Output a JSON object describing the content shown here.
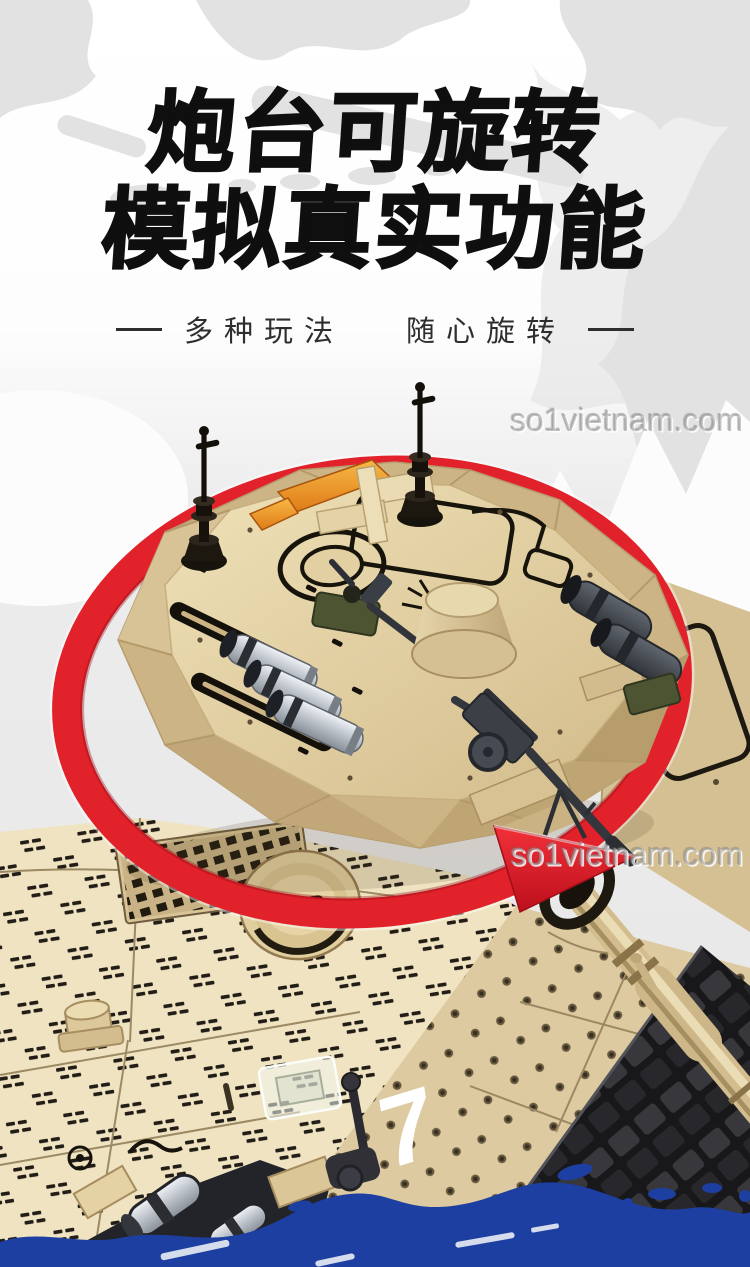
{
  "banner": {
    "headline": {
      "line1": "炮台可旋转",
      "line2": "模拟真实功能"
    },
    "subtitle": {
      "left": "多种玩法",
      "right": "随心旋转"
    },
    "watermark": "so1vietnam.com",
    "hull_marking": "7"
  },
  "colors": {
    "accent_red": "#e2222a",
    "wave_blue": "#1d3fa2",
    "title_black": "#0f0f0f",
    "tan_light": "#f0e4c3",
    "tan_mid": "#dfcb9e",
    "tan_dark": "#c9b080",
    "map_gray": "#e2e2e2",
    "bg_gray": "#eaeaea"
  }
}
